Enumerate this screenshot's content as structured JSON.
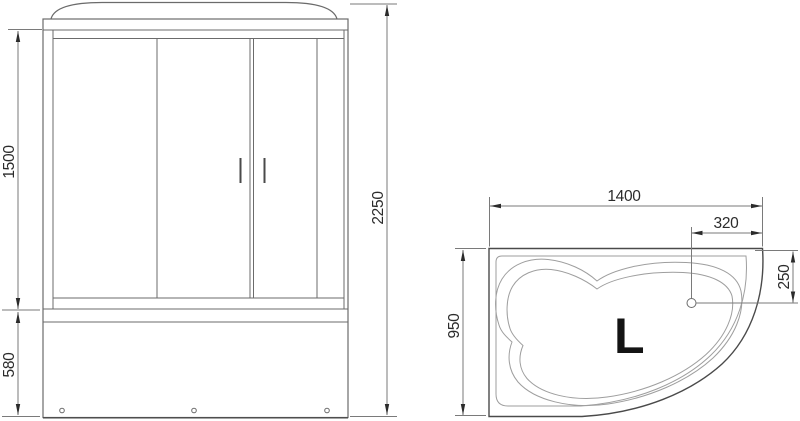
{
  "colors": {
    "line": "#6b6b6b",
    "line_light": "#9e9e9e",
    "line_dark": "#4a4a4a",
    "dim": "#7a7a7a",
    "text": "#2b2b2b",
    "label": "#141414",
    "background": "#ffffff"
  },
  "front_view": {
    "dimensions": {
      "glass_height": "1500",
      "base_height": "580",
      "total_height": "2250"
    }
  },
  "top_view": {
    "dimensions": {
      "width": "1400",
      "drain_from_right": "320",
      "drain_from_top": "250",
      "depth": "950"
    },
    "orientation_label": "L"
  }
}
